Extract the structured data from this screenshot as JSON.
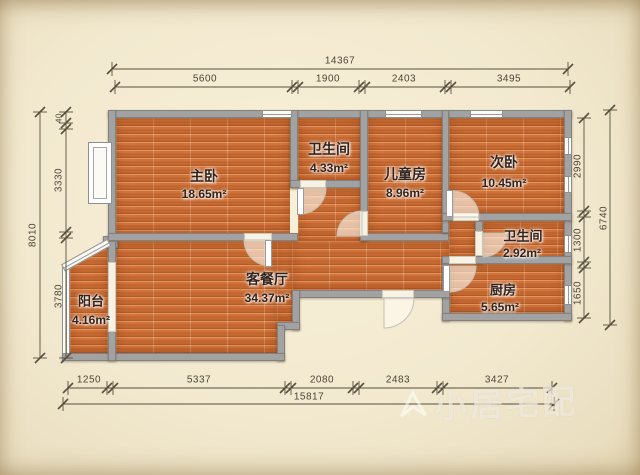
{
  "plan": {
    "rooms": [
      {
        "name": "主卧",
        "area": "18.65m²"
      },
      {
        "name": "卫生间",
        "area": "4.33m²"
      },
      {
        "name": "儿童房",
        "area": "8.96m²"
      },
      {
        "name": "次卧",
        "area": "10.45m²"
      },
      {
        "name": "卫生间",
        "area": "2.92m²"
      },
      {
        "name": "厨房",
        "area": "5.65m²"
      },
      {
        "name": "客餐厅",
        "area": "34.37m²"
      },
      {
        "name": "阳台",
        "area": "4.16m²"
      }
    ],
    "dimensions": {
      "top": {
        "total": "14367",
        "segments": [
          "5600",
          "1900",
          "2403",
          "3495"
        ]
      },
      "bottom": {
        "total": "15817",
        "segments": [
          "1250",
          "5337",
          "2080",
          "2483",
          "3427"
        ]
      },
      "left": {
        "total": "8010",
        "segments": [
          "40",
          "3330",
          "3780"
        ]
      },
      "right": {
        "total": "6740",
        "segments": [
          "2990",
          "1300",
          "1650"
        ]
      }
    },
    "watermark": "小居宅配",
    "colors": {
      "floor": "#d2733c",
      "wall": "#a2a2a2",
      "paper": "#f2e9cf",
      "dimension": "#4c4538"
    }
  }
}
